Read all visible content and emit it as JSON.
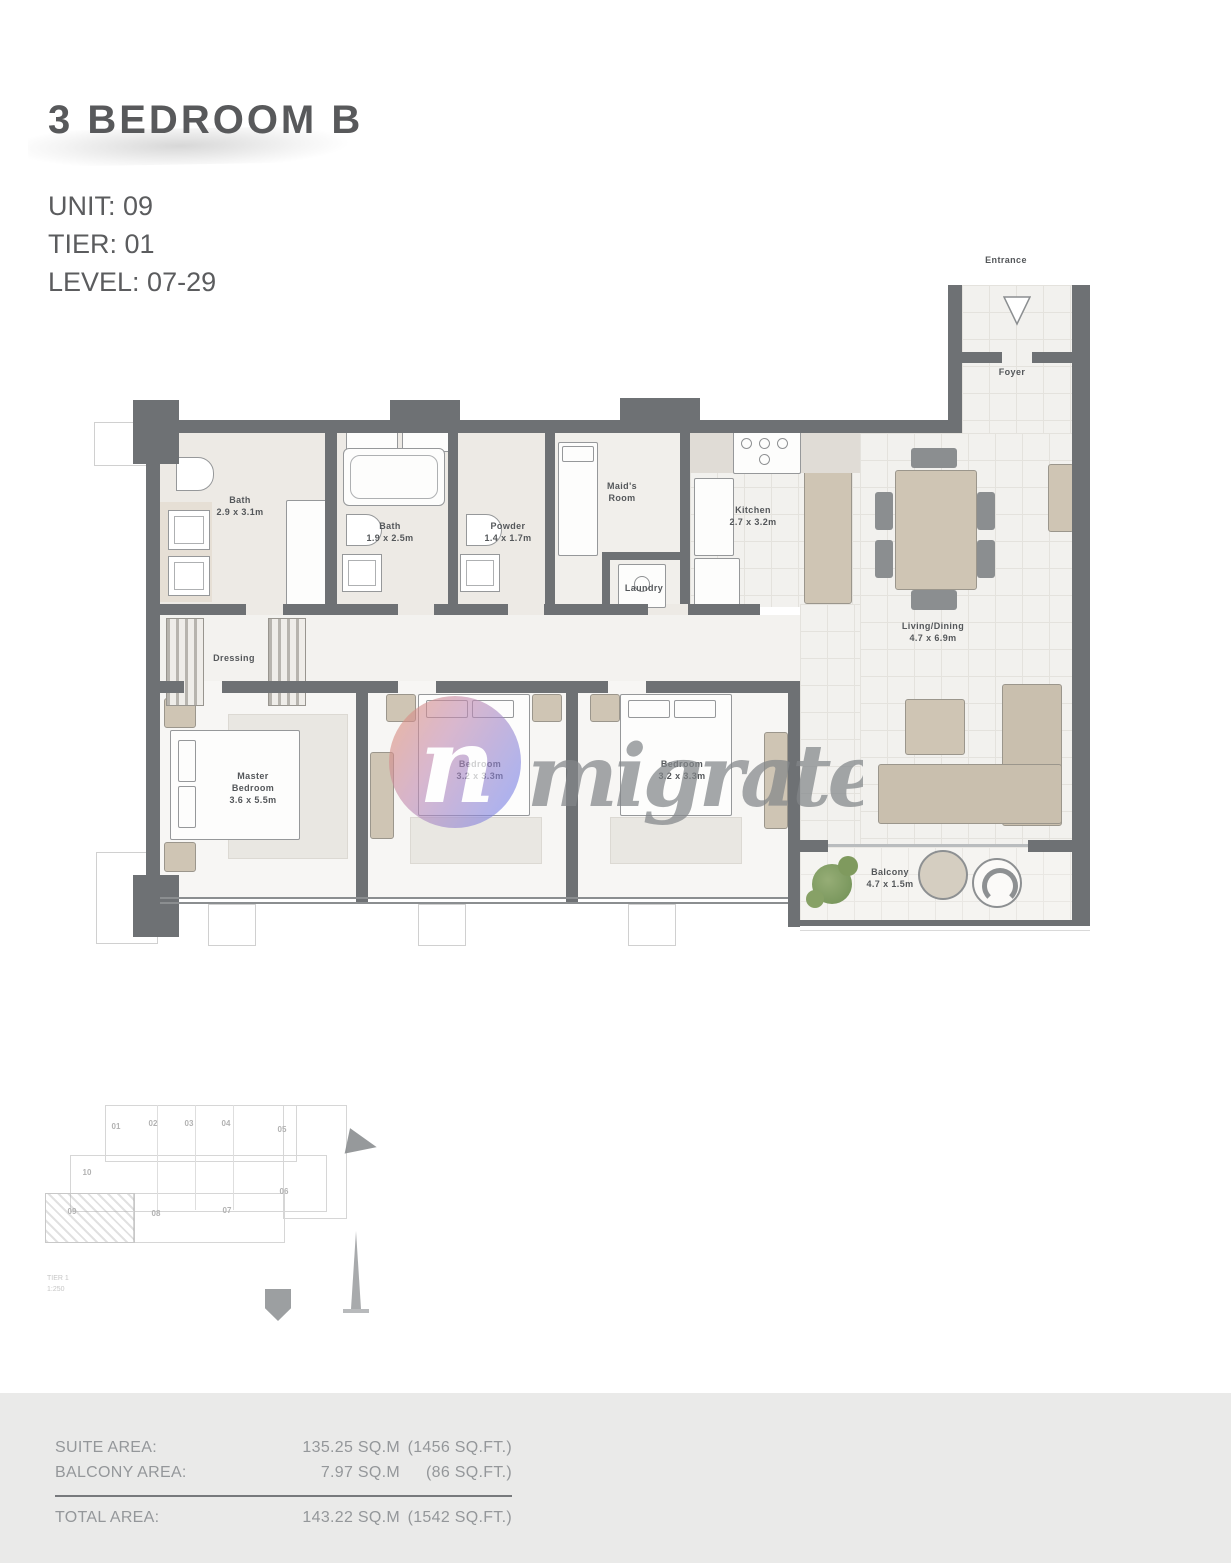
{
  "header": {
    "title": "3 BEDROOM B",
    "unit": "UNIT: 09",
    "tier": "TIER: 01",
    "level": "LEVEL: 07-29"
  },
  "plan": {
    "rooms": {
      "entrance": {
        "name": "Entrance"
      },
      "foyer": {
        "name": "Foyer"
      },
      "bath1": {
        "name": "Bath",
        "dims": "2.9 x 3.1m"
      },
      "bath2": {
        "name": "Bath",
        "dims": "1.9 x 2.5m"
      },
      "powder": {
        "name": "Powder",
        "dims": "1.4 x 1.7m"
      },
      "maids": {
        "name": "Maid's Room"
      },
      "laundry": {
        "name": "Laundry"
      },
      "kitchen": {
        "name": "Kitchen",
        "dims": "2.7 x 3.2m"
      },
      "living": {
        "name": "Living/Dining",
        "dims": "4.7 x 6.9m"
      },
      "dressing": {
        "name": "Dressing"
      },
      "master": {
        "name": "Master Bedroom",
        "dims": "3.6 x 5.5m"
      },
      "bedroom2": {
        "name": "Bedroom",
        "dims": "3.2 x 3.3m"
      },
      "bedroom3": {
        "name": "Bedroom",
        "dims": "3.2 x 3.3m"
      },
      "balcony": {
        "name": "Balcony",
        "dims": "4.7 x 1.5m"
      }
    }
  },
  "watermark": {
    "monogram": "n",
    "brand": "migrate"
  },
  "keyplan": {
    "units": [
      "01",
      "02",
      "03",
      "04",
      "05",
      "06",
      "07",
      "08",
      "09",
      "10"
    ],
    "note1": "TIER 1",
    "note2": "1:250"
  },
  "areas": {
    "rows": [
      {
        "label": "SUITE AREA:",
        "sqm": "135.25 SQ.M",
        "sqft": "(1456 SQ.FT.)"
      },
      {
        "label": "BALCONY AREA:",
        "sqm": "7.97 SQ.M",
        "sqft": "(86 SQ.FT.)"
      }
    ],
    "total": {
      "label": "TOTAL AREA:",
      "sqm": "143.22 SQ.M",
      "sqft": "(1542 SQ.FT.)"
    }
  }
}
